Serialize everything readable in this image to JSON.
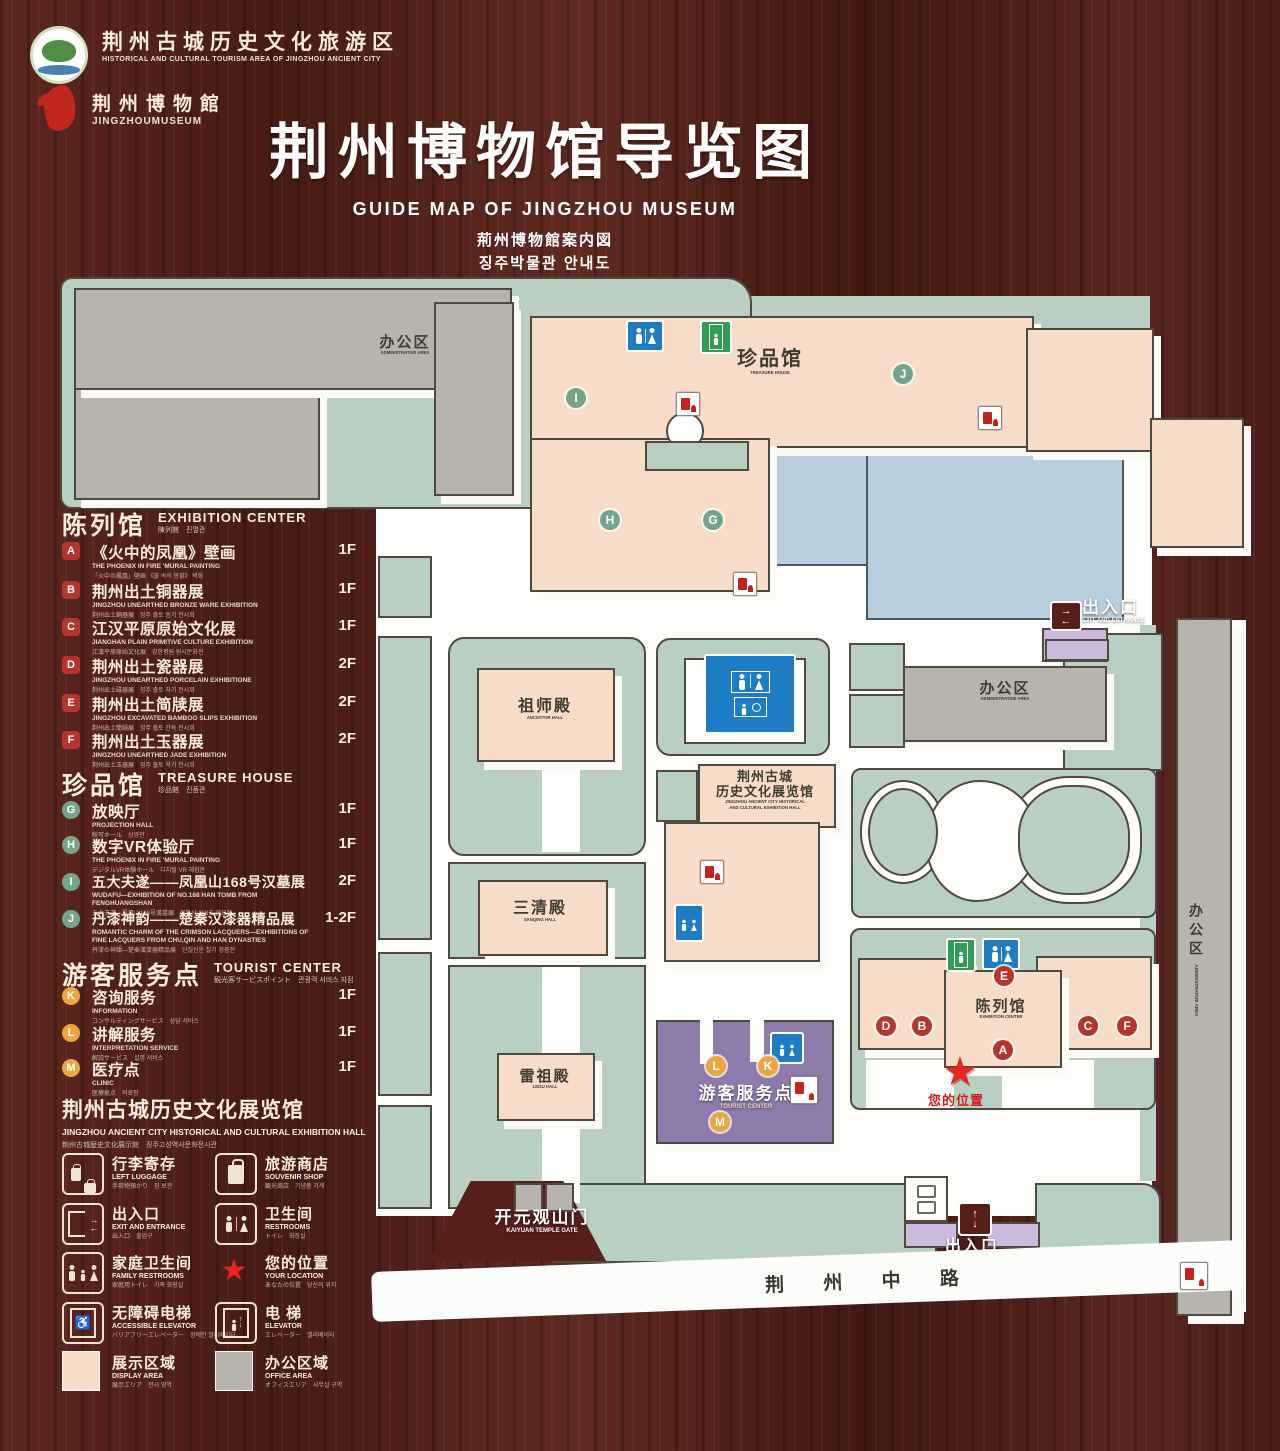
{
  "header": {
    "logo_tourism": {
      "cn": "荆州古城历史文化旅游区",
      "en": "HISTORICAL AND CULTURAL TOURISM AREA OF JINGZHOU ANCIENT CITY"
    },
    "logo_museum": {
      "cn": "荆州博物館",
      "en": "JINGZHOUMUSEUM"
    },
    "title_cn": "荆州博物馆导览图",
    "title_en": "GUIDE MAP OF JINGZHOU MUSEUM",
    "title_ja": "荊州博物館案内図",
    "title_ko": "징주박물관 안내도"
  },
  "legend": {
    "exhibition": {
      "cn": "陈列馆",
      "en": "EXHIBITION CENTER",
      "sub": "陳列館　진열관",
      "items": [
        {
          "letter": "A",
          "cn": "《火中的凤凰》壁画",
          "en": "THE PHOENIX IN FIRE 'MURAL PAINTING",
          "sub": "「火中の鳳凰」壁画 《불 속의 봉황》 벽화",
          "floor": "1F"
        },
        {
          "letter": "B",
          "cn": "荆州出土铜器展",
          "en": "JINGZHOU UNEARTHED BRONZE WARE EXHIBITION",
          "sub": "荆州出土銅器展　징주 출토 동기 전시회",
          "floor": "1F"
        },
        {
          "letter": "C",
          "cn": "江汉平原原始文化展",
          "en": "JIANGHAN PLAIN PRIMITIVE CULTURE EXHIBITION",
          "sub": "江漢平原原始文化展　강한평원 원시문화전",
          "floor": "1F"
        },
        {
          "letter": "D",
          "cn": "荆州出土瓷器展",
          "en": "JINGZHOU UNEARTHED PORCELAIN EXHIBITIONE",
          "sub": "荆州出土磁器展　징주 출토 자기 전시회",
          "floor": "2F"
        },
        {
          "letter": "E",
          "cn": "荆州出土简牍展",
          "en": "JINGZHOU EXCAVATED BAMBOO SLIPS EXHIBITION",
          "sub": "荆州出土簡牘展　징주 출토 간독 전시회",
          "floor": "2F"
        },
        {
          "letter": "F",
          "cn": "荆州出土玉器展",
          "en": "JINGZHOU UNEARTHED JADE EXHIBITION",
          "sub": "荆州出土玉器展　징주 출토 옥기 전시회",
          "floor": "2F"
        }
      ]
    },
    "treasure": {
      "cn": "珍品馆",
      "en": "TREASURE HOUSE",
      "sub": "珍品館　진품관",
      "items": [
        {
          "letter": "G",
          "cn": "放映厅",
          "en": "PROJECTION HALL",
          "sub": "映写ホール　상영관",
          "floor": "1F"
        },
        {
          "letter": "H",
          "cn": "数字VR体验厅",
          "en": "THE PHOENIX IN FIRE 'MURAL PAINTING",
          "sub": "デジタルVR体験ホール　디지털 VR 체험관",
          "floor": "1F"
        },
        {
          "letter": "I",
          "cn": "五大夫遂——凤凰山168号汉墓展",
          "en": "WUDAFU—EXHIBITION OF NO.168 HAN TOMB FROM FENGHUANGSHAN",
          "sub": "五大夫遂—鳳凰山168号漢墓展　봉황산 168호 한묘전",
          "floor": "2F"
        },
        {
          "letter": "J",
          "cn": "丹漆神韵——楚秦汉漆器精品展",
          "en": "ROMANTIC CHARM OF THE CRIMSON LACQUERS—EXHIBITIONS OF FINE LACQUERS FROM CHU,QIN AND HAN DYNASTIES",
          "sub": "丹漆の神韻—楚秦漢漆器精品展　단칠신운 칠기 정품전",
          "floor": "1-2F"
        }
      ]
    },
    "tourist": {
      "cn": "游客服务点",
      "en": "TOURIST CENTER",
      "sub": "観光客サービスポイント　관광객 서비스 지점",
      "items": [
        {
          "letter": "K",
          "cn": "咨询服务",
          "en": "INFORMATION",
          "sub": "コンサルティングサービス　상담 서비스",
          "floor": "1F"
        },
        {
          "letter": "L",
          "cn": "讲解服务",
          "en": "INTERPRETATION SERVICE",
          "sub": "解説サービス　설명 서비스",
          "floor": "1F"
        },
        {
          "letter": "M",
          "cn": "医疗点",
          "en": "CLINIC",
          "sub": "医療拠点　의료점",
          "floor": "1F"
        }
      ]
    },
    "hall": {
      "cn": "荆州古城历史文化展览馆",
      "en": "JINGZHOU ANCIENT CITY HISTORICAL AND CULTURAL EXHIBITION HALL",
      "sub": "荆州古城歴史文化展示館　징주고성역사문화전시관"
    },
    "symbols": [
      {
        "icon": "left-luggage-icon",
        "cn": "行李寄存",
        "en": "LEFT LUGGAGE",
        "sub": "手荷物預かり　짐 보관"
      },
      {
        "icon": "souvenir-shop-icon",
        "cn": "旅游商店",
        "en": "SOUVENIR SHOP",
        "sub": "観光商店　기념품 가게"
      },
      {
        "icon": "exit-entrance-icon",
        "cn": "出入口",
        "en": "EXIT AND ENTRANCE",
        "sub": "出入口　출입구"
      },
      {
        "icon": "restrooms-icon",
        "cn": "卫生间",
        "en": "RESTROOMS",
        "sub": "トイレ　화장실"
      },
      {
        "icon": "family-restrooms-icon",
        "cn": "家庭卫生间",
        "en": "FAMILY RESTROOMS",
        "sub": "家庭用トイレ　가족 화장실"
      },
      {
        "icon": "your-location-icon",
        "cn": "您的位置",
        "en": "YOUR LOCATION",
        "sub": "あなたの位置　당신의 위치"
      },
      {
        "icon": "accessible-elevator-icon",
        "cn": "无障碍电梯",
        "en": "ACCESSIBLE ELEVATOR",
        "sub": "バリアフリーエレベーター　장애인 엘리베이터"
      },
      {
        "icon": "elevator-icon",
        "cn": "电 梯",
        "en": "ELEVATOR",
        "sub": "エレベーター　엘리베이터"
      },
      {
        "icon": "display-area-swatch",
        "cn": "展示区域",
        "en": "DISPLAY AREA",
        "sub": "展示エリア　전시 영역"
      },
      {
        "icon": "office-area-swatch",
        "cn": "办公区域",
        "en": "OFFICE AREA",
        "sub": "オフィスエリア　사무실 구역"
      }
    ]
  },
  "map": {
    "nw_admin": {
      "cn": "办公区",
      "en": "ADMINISTRATIVE AREA"
    },
    "treasure": {
      "cn": "珍品馆",
      "en": "TREASURE HOUSE"
    },
    "ancestor": {
      "cn": "祖师殿",
      "en": "ANCESTOR HALL"
    },
    "sanqing": {
      "cn": "三清殿",
      "en": "SANQING HALL"
    },
    "leizu": {
      "cn": "雷祖殿",
      "en": "LEIZU HALL"
    },
    "hist": {
      "cn1": "荆州古城",
      "cn2": "历史文化展览馆",
      "en1": "JINGZHOU ANCIENT CITY HISTORICAL",
      "en2": "AND CULTURAL EXHIBITION HALL"
    },
    "e_admin": {
      "cn": "办公区",
      "en": "ADMINISTRATIVE AREA"
    },
    "strip_admin": {
      "cn": "办公区",
      "en": "ADMINISTRATIVE AREA"
    },
    "tourist": {
      "cn": "游客服务点",
      "en": "TOURIST CENTER"
    },
    "exhibition": {
      "cn": "陈列馆",
      "en": "EXHIBITION CENTER"
    },
    "exit_ne": {
      "cn": "出入口",
      "en": "EXIT AND ENTRANCE"
    },
    "exit_s": {
      "cn": "出入口",
      "en": "EXIT AND ENTRANCE"
    },
    "gate": {
      "cn": "开元观山门",
      "en": "KAIYUAN TEMPLE GATE"
    },
    "road": {
      "cn": "荆 州 中 路"
    },
    "location": {
      "cn": "您的位置"
    },
    "markers": {
      "A": "A",
      "B": "B",
      "C": "C",
      "D": "D",
      "E": "E",
      "F": "F",
      "G": "G",
      "H": "H",
      "I": "I",
      "J": "J",
      "K": "K",
      "L": "L",
      "M": "M"
    }
  },
  "colors": {
    "wood": "#4a1d18",
    "parcel_green": "#b9cfc2",
    "path_white": "#fdfdfb",
    "building_pink": "#f7dcc9",
    "building_gray": "#b7b4ad",
    "pond_blue": "#b9cedd",
    "tourist_purple": "#8d7cab",
    "gate_purple": "#cbbade",
    "outline": "#4f4a40",
    "marker_red": "#b5342c",
    "marker_green": "#74a58a",
    "marker_orange": "#eda53f",
    "restroom_blue": "#1d7cc3",
    "elevator_green": "#2f9e54",
    "location_red": "#e8251f",
    "legend_text": "#f6ecdc"
  }
}
